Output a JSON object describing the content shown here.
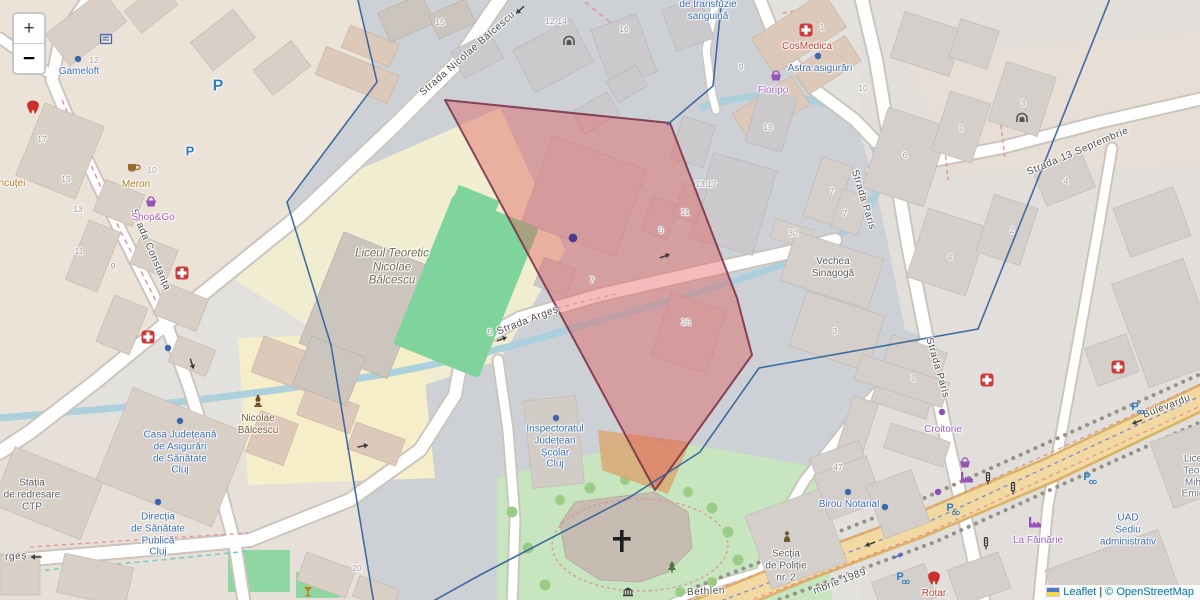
{
  "map": {
    "controls": {
      "zoom_in": "+",
      "zoom_out": "−"
    },
    "attribution": {
      "flag": "ukraine-flag",
      "leaflet": "Leaflet",
      "separator": "|",
      "copyright": "© OpenStreetMap"
    },
    "colors": {
      "selection_fill": "#e25555",
      "selection_border": "#772d45",
      "boundary_line": "#2f5f9c",
      "water": "#a9cfdd",
      "school_area": "#f0edd1",
      "park": "#c7e6c0",
      "pitch": "#7fd49c",
      "boulevard": "#f2d9a2",
      "poi_blue": "#3b6db4",
      "poi_red": "#c33b33",
      "poi_purple": "#9c5fc0"
    },
    "street_labels": [
      {
        "name": "street-strada-nicolae-balcescu",
        "text": "Strada Nicolae Bălcescu",
        "x": 468,
        "y": 54,
        "rot": -41
      },
      {
        "name": "street-strada-constanta",
        "text": "Strada Constanța",
        "x": 150,
        "y": 250,
        "rot": 67
      },
      {
        "name": "street-strada-arges",
        "text": "Strada Argeș",
        "x": 528,
        "y": 321,
        "rot": -21
      },
      {
        "name": "street-strada-arges-partial",
        "text": "rgeș",
        "x": 16,
        "y": 557,
        "rot": -4
      },
      {
        "name": "street-strada-paris-north",
        "text": "Strada Paris",
        "x": 863,
        "y": 200,
        "rot": 73
      },
      {
        "name": "street-strada-paris-south",
        "text": "Strada Paris",
        "x": 937,
        "y": 368,
        "rot": 74
      },
      {
        "name": "street-strada-13-septembrie",
        "text": "Strada 13 Septembrie",
        "x": 1078,
        "y": 152,
        "rot": -23
      },
      {
        "name": "street-bulevardul-partial",
        "text": "Bulevardu",
        "x": 1167,
        "y": 407,
        "rot": -21
      },
      {
        "name": "street-bulevardul-1989-partial",
        "text": "mbrie 1989",
        "x": 840,
        "y": 582,
        "rot": -21
      },
      {
        "name": "street-bethlen",
        "text": "Bethlen",
        "x": 706,
        "y": 592,
        "rot": -3
      }
    ],
    "house_numbers": [
      {
        "text": "17",
        "x": 42,
        "y": 139
      },
      {
        "text": "15",
        "x": 66,
        "y": 179
      },
      {
        "text": "13",
        "x": 78,
        "y": 209
      },
      {
        "text": "11",
        "x": 79,
        "y": 251
      },
      {
        "text": "9",
        "x": 113,
        "y": 266
      },
      {
        "text": "12",
        "x": 94,
        "y": 60
      },
      {
        "text": "10",
        "x": 152,
        "y": 170
      },
      {
        "text": "15",
        "x": 440,
        "y": 22
      },
      {
        "text": "12-14",
        "x": 556,
        "y": 21
      },
      {
        "text": "16",
        "x": 624,
        "y": 29
      },
      {
        "text": "9",
        "x": 741,
        "y": 67
      },
      {
        "text": "1",
        "x": 822,
        "y": 27
      },
      {
        "text": "10",
        "x": 863,
        "y": 88
      },
      {
        "text": "19",
        "x": 768,
        "y": 127
      },
      {
        "text": "13:17",
        "x": 706,
        "y": 184
      },
      {
        "text": "7",
        "x": 592,
        "y": 280
      },
      {
        "text": "9",
        "x": 661,
        "y": 230
      },
      {
        "text": "11",
        "x": 685,
        "y": 212
      },
      {
        "text": "26",
        "x": 686,
        "y": 322
      },
      {
        "text": "30",
        "x": 793,
        "y": 233
      },
      {
        "text": "7",
        "x": 832,
        "y": 191
      },
      {
        "text": "7",
        "x": 845,
        "y": 213
      },
      {
        "text": "6",
        "x": 905,
        "y": 155
      },
      {
        "text": "1",
        "x": 961,
        "y": 128
      },
      {
        "text": "3",
        "x": 1023,
        "y": 103
      },
      {
        "text": "4",
        "x": 1066,
        "y": 181
      },
      {
        "text": "4",
        "x": 950,
        "y": 257
      },
      {
        "text": "2",
        "x": 1012,
        "y": 230
      },
      {
        "text": "3",
        "x": 835,
        "y": 331
      },
      {
        "text": "1",
        "x": 913,
        "y": 378
      },
      {
        "text": "47",
        "x": 838,
        "y": 467
      },
      {
        "text": "20",
        "x": 357,
        "y": 568
      },
      {
        "text": "5",
        "x": 490,
        "y": 332
      }
    ],
    "poi_labels": [
      {
        "name": "poi-gameloft",
        "kind": "blue",
        "text": "Gameloft",
        "x": 79,
        "y": 72
      },
      {
        "name": "poi-centrul-transfuzie",
        "kind": "blue",
        "text": "de transfuzie\nsanguină",
        "x": 708,
        "y": 11
      },
      {
        "name": "poi-astra-asigurari",
        "kind": "blue",
        "text": "Astra asigurări",
        "x": 820,
        "y": 69
      },
      {
        "name": "poi-cosmedica",
        "kind": "red",
        "text": "CosMedica",
        "x": 807,
        "y": 47
      },
      {
        "name": "poi-floripo",
        "kind": "purple",
        "text": "Floripo",
        "x": 773,
        "y": 91
      },
      {
        "name": "poi-meron",
        "kind": "orange",
        "text": "Meron",
        "x": 136,
        "y": 185
      },
      {
        "name": "poi-shop-go",
        "kind": "purple2",
        "text": "Shop&Go",
        "x": 153,
        "y": 218
      },
      {
        "name": "poi-lancutei-partial",
        "kind": "orange",
        "text": "ncuței",
        "x": 12,
        "y": 184
      },
      {
        "name": "poi-liceul-teoretic-nicolae-balcescu",
        "kind": "olive",
        "text": "Liceul Teoretic\nNicolae\nBălcescu",
        "x": 392,
        "y": 268
      },
      {
        "name": "poi-monument-nicolae-balcescu",
        "kind": "brown",
        "text": "Nicolae\nBălcescu",
        "x": 258,
        "y": 425
      },
      {
        "name": "poi-casa-judeteana",
        "kind": "blue",
        "text": "Casa Județeană\nde Asigurări\nde Sănătate\nCluj",
        "x": 180,
        "y": 453
      },
      {
        "name": "poi-directia-sanatate",
        "kind": "blue",
        "text": "Direcția\nde Sănătate\nPublică\nCluj",
        "x": 158,
        "y": 535
      },
      {
        "name": "poi-statia-redresare-ctp",
        "kind": "gray",
        "text": "Stația\nde redresare\nCTP",
        "x": 32,
        "y": 495
      },
      {
        "name": "poi-inspectoratul-scolar",
        "kind": "blue",
        "text": "Inspectoratul\nJudețean\nȘcolar\nCluj",
        "x": 555,
        "y": 447
      },
      {
        "name": "poi-vechea-sinagoga",
        "kind": "gray",
        "text": "Vechea\nSinagogă",
        "x": 833,
        "y": 268
      },
      {
        "name": "poi-birou-notarial",
        "kind": "blue",
        "text": "Birou Notarial",
        "x": 849,
        "y": 505
      },
      {
        "name": "poi-croitorie",
        "kind": "purple",
        "text": "Croitorie",
        "x": 943,
        "y": 430
      },
      {
        "name": "poi-sectia-politie",
        "kind": "gray",
        "text": "Secția\nde Poliție\nnr. 2",
        "x": 786,
        "y": 566
      },
      {
        "name": "poi-rotar",
        "kind": "red",
        "text": "Rotar",
        "x": 934,
        "y": 594
      },
      {
        "name": "poi-la-fainarie",
        "kind": "purple",
        "text": "La Făinărie",
        "x": 1038,
        "y": 541
      },
      {
        "name": "poi-uad-sediu",
        "kind": "blue",
        "text": "UAD\nSediu\nadministrativ",
        "x": 1128,
        "y": 530
      },
      {
        "name": "poi-liceu-eminescu-partial",
        "kind": "grayblue",
        "text": "Lice\nTeor\nMih\nEmin",
        "x": 1193,
        "y": 477
      },
      {
        "name": "poi-parking-large",
        "kind": "pblue",
        "text": "P",
        "x": 218,
        "y": 87,
        "fs": 16
      },
      {
        "name": "poi-parking-small",
        "kind": "pblue",
        "text": "P",
        "x": 190,
        "y": 151,
        "fs": 13
      }
    ],
    "icons": [
      {
        "name": "poi-dot-icon",
        "t": "dot",
        "x": 78,
        "y": 59,
        "c": "#3a67ad"
      },
      {
        "name": "poi-dot-icon",
        "t": "dot",
        "x": 818,
        "y": 56,
        "c": "#3a67ad"
      },
      {
        "name": "poi-dot-icon",
        "t": "dot",
        "x": 180,
        "y": 421,
        "c": "#3a67ad"
      },
      {
        "name": "poi-dot-icon",
        "t": "dot",
        "x": 158,
        "y": 502,
        "c": "#3a67ad"
      },
      {
        "name": "poi-dot-icon",
        "t": "dot",
        "x": 556,
        "y": 418,
        "c": "#3a67ad"
      },
      {
        "name": "poi-dot-icon",
        "t": "dot",
        "x": 848,
        "y": 492,
        "c": "#3a67ad"
      },
      {
        "name": "poi-dot-icon",
        "t": "dot",
        "x": 885,
        "y": 507,
        "c": "#3a67ad"
      },
      {
        "name": "poi-dot-icon",
        "t": "dot",
        "x": 168,
        "y": 348,
        "c": "#3a67ad"
      },
      {
        "name": "poi-dot-icon",
        "t": "dot",
        "x": 942,
        "y": 412,
        "c": "#8d4fb0"
      },
      {
        "name": "poi-dot-icon",
        "t": "dot",
        "x": 938,
        "y": 492,
        "c": "#8d4fb0"
      },
      {
        "name": "selection-marker-icon",
        "t": "dot",
        "x": 573,
        "y": 238,
        "c": "#4a3a8c",
        "s": 1.35
      },
      {
        "name": "pharmacy-icon",
        "t": "cross",
        "x": 182,
        "y": 273,
        "c": "#cc3b3b"
      },
      {
        "name": "pharmacy-icon",
        "t": "cross",
        "x": 148,
        "y": 337,
        "c": "#cc3b3b"
      },
      {
        "name": "pharmacy-icon",
        "t": "cross",
        "x": 987,
        "y": 380,
        "c": "#cc3b3b"
      },
      {
        "name": "pharmacy-icon",
        "t": "cross",
        "x": 1118,
        "y": 367,
        "c": "#cc3b3b"
      },
      {
        "name": "clinic-icon",
        "t": "cross",
        "x": 806,
        "y": 30,
        "c": "#cc3b3b"
      },
      {
        "name": "dentist-icon",
        "t": "tooth",
        "x": 33,
        "y": 107,
        "c": "#c9302c"
      },
      {
        "name": "dentist-icon",
        "t": "tooth",
        "x": 934,
        "y": 578,
        "c": "#c9302c"
      },
      {
        "name": "cafe-icon",
        "t": "cup",
        "x": 133,
        "y": 167,
        "c": "#9a6b2e"
      },
      {
        "name": "supermarket-icon",
        "t": "basket",
        "x": 151,
        "y": 202,
        "c": "#9654b8"
      },
      {
        "name": "florist-icon",
        "t": "basket",
        "x": 776,
        "y": 76,
        "c": "#9654b8"
      },
      {
        "name": "shop-icon",
        "t": "basket",
        "x": 965,
        "y": 463,
        "c": "#9654b8"
      },
      {
        "name": "factory-icon",
        "t": "factory",
        "x": 967,
        "y": 478,
        "c": "#9654b8"
      },
      {
        "name": "factory-icon",
        "t": "factory",
        "x": 1035,
        "y": 523,
        "c": "#9654b8"
      },
      {
        "name": "statue-icon",
        "t": "statue",
        "x": 258,
        "y": 402,
        "c": "#6e4a28"
      },
      {
        "name": "archway-icon",
        "t": "arch",
        "x": 569,
        "y": 41,
        "c": "#555555"
      },
      {
        "name": "archway-icon",
        "t": "arch",
        "x": 1022,
        "y": 118,
        "c": "#555555"
      },
      {
        "name": "traffic-light-icon",
        "t": "traffic",
        "x": 988,
        "y": 478,
        "c": "#3c3c3c"
      },
      {
        "name": "traffic-light-icon",
        "t": "traffic",
        "x": 1013,
        "y": 488,
        "c": "#3c3c3c"
      },
      {
        "name": "traffic-light-icon",
        "t": "traffic",
        "x": 986,
        "y": 543,
        "c": "#3c3c3c"
      },
      {
        "name": "police-icon",
        "t": "person",
        "x": 787,
        "y": 537,
        "c": "#6b5a30"
      },
      {
        "name": "classical-building-icon",
        "t": "classic",
        "x": 628,
        "y": 592,
        "c": "#3a3a3a"
      },
      {
        "name": "bar-icon",
        "t": "glass",
        "x": 308,
        "y": 592,
        "c": "#c77400"
      },
      {
        "name": "bicycle-parking-icon",
        "t": "bikep",
        "x": 1135,
        "y": 407,
        "c": "#2a7cc7"
      },
      {
        "name": "bicycle-parking-icon",
        "t": "bikep",
        "x": 1087,
        "y": 477,
        "c": "#2a7cc7"
      },
      {
        "name": "bicycle-parking-icon",
        "t": "bikep",
        "x": 950,
        "y": 508,
        "c": "#2a7cc7"
      },
      {
        "name": "bicycle-parking-icon",
        "t": "bikep",
        "x": 900,
        "y": 577,
        "c": "#2a7cc7"
      },
      {
        "name": "amenity-icon",
        "t": "amenity",
        "x": 106,
        "y": 39,
        "c": "#3a67ad"
      },
      {
        "name": "tree-icon",
        "t": "spruce",
        "x": 672,
        "y": 567,
        "c": "#4a7a3a"
      },
      {
        "name": "one-way-arrow-icon",
        "t": "arrow",
        "x": 502,
        "y": 339,
        "c": "#3c3c3c",
        "r": -22
      },
      {
        "name": "one-way-arrow-icon",
        "t": "arrow",
        "x": 665,
        "y": 256,
        "c": "#3c3c3c",
        "r": -20
      },
      {
        "name": "one-way-arrow-icon",
        "t": "arrow",
        "x": 36,
        "y": 557,
        "c": "#3c3c3c",
        "r": 180
      },
      {
        "name": "one-way-arrow-icon",
        "t": "arrow",
        "x": 1137,
        "y": 422,
        "c": "#3c3c3c",
        "r": 158
      },
      {
        "name": "one-way-arrow-icon",
        "t": "arrow",
        "x": 870,
        "y": 544,
        "c": "#3c3c3c",
        "r": 158
      },
      {
        "name": "cycle-lane-arrow-icon",
        "t": "arrow",
        "x": 898,
        "y": 556,
        "c": "#4a5fd0",
        "r": -22
      },
      {
        "name": "one-way-arrow-icon",
        "t": "arrow",
        "x": 192,
        "y": 364,
        "c": "#3c3c3c",
        "r": 72
      },
      {
        "name": "one-way-arrow-icon",
        "t": "arrow",
        "x": 363,
        "y": 446,
        "c": "#3c3c3c",
        "r": -10
      },
      {
        "name": "one-way-arrow-icon",
        "t": "arrow",
        "x": 520,
        "y": 10,
        "c": "#3c3c3c",
        "r": 137
      }
    ]
  }
}
